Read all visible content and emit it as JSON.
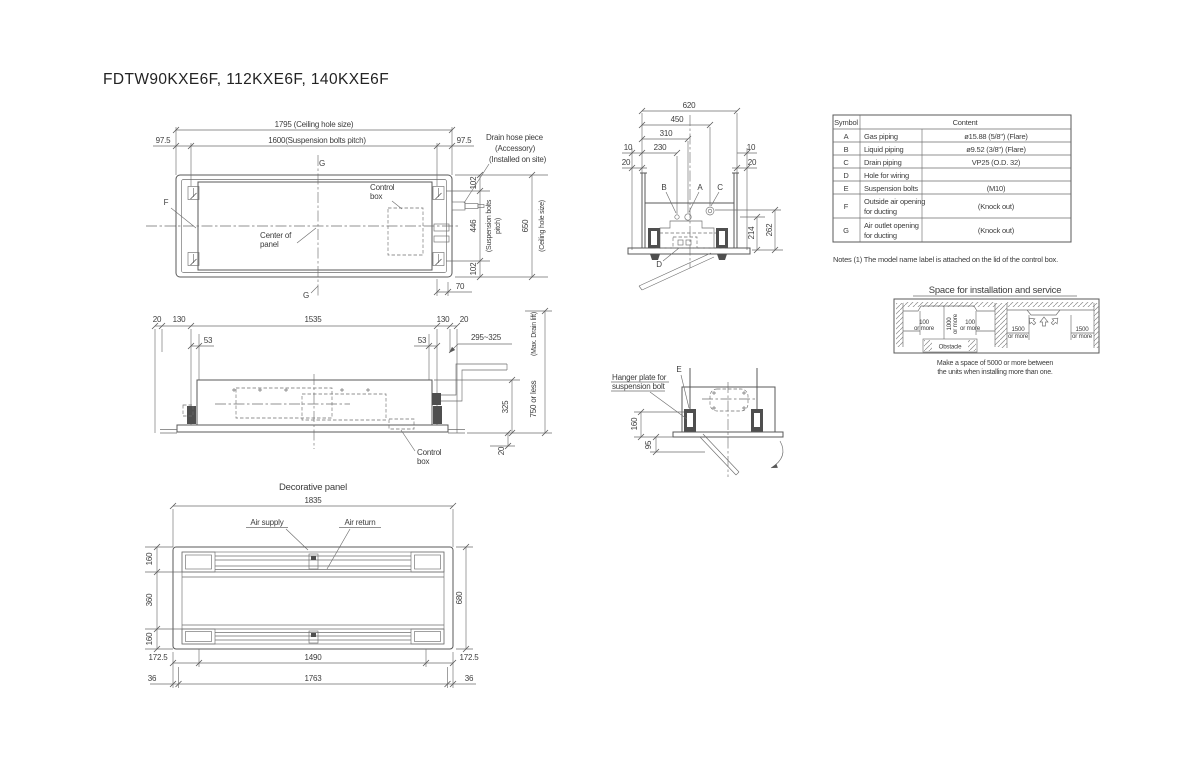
{
  "title": "FDTW90KXE6F, 112KXE6F, 140KXE6F",
  "plan_view": {
    "dim_ceiling_width": "1795 (Ceiling hole size)",
    "dim_bolt_pitch_width": "1600(Suspension bolts pitch)",
    "offset_left": "97.5",
    "offset_right": "97.5",
    "section_g_top": "G",
    "section_g_bottom": "G",
    "symbol_f": "F",
    "control_box_l1": "Control",
    "control_box_l2": "box",
    "center_l1": "Center of",
    "center_l2": "panel",
    "drain_l1": "Drain hose piece",
    "drain_l2": "(Accessory)",
    "drain_l3": "(Installed on site)",
    "dim_102_top": "102",
    "dim_446": "446",
    "bolt_pitch_l1": "(Suspension bolts",
    "bolt_pitch_l2": "pitch)",
    "dim_650": "650",
    "ceiling_note": "(Ceiling hole size)",
    "dim_102_bottom": "102",
    "dim_70": "70"
  },
  "side_view": {
    "dim_20_l": "20",
    "dim_130_l": "130",
    "dim_1535": "1535",
    "dim_130_r": "130",
    "dim_20_r": "20",
    "dim_53_l": "53",
    "dim_53_r": "53",
    "dim_drain_range": "295~325",
    "max_drain_lift": "(Max. Drain lift)",
    "dim_750": "750 or less",
    "dim_325": "325",
    "dim_20_b": "20",
    "control_box_l1": "Control",
    "control_box_l2": "box"
  },
  "end_view": {
    "dim_620": "620",
    "dim_450": "450",
    "dim_310": "310",
    "dim_230": "230",
    "dim_10_l": "10",
    "dim_20_l": "20",
    "dim_10_r": "10",
    "dim_20_r": "20",
    "sym_b": "B",
    "sym_a": "A",
    "sym_c": "C",
    "sym_d": "D",
    "dim_214": "214",
    "dim_262": "262"
  },
  "hanger_view": {
    "label_l1": "Hanger plate for",
    "label_l2": "suspension bolt",
    "sym_e": "E",
    "dim_160": "160",
    "dim_95": "95"
  },
  "panel_view": {
    "title": "Decorative panel",
    "dim_1835": "1835",
    "air_supply": "Air supply",
    "air_return": "Air return",
    "dim_160_t": "160",
    "dim_360": "360",
    "dim_160_b": "160",
    "dim_680": "680",
    "dim_1725_l": "172.5",
    "dim_1490": "1490",
    "dim_1725_r": "172.5",
    "dim_36_l": "36",
    "dim_1763": "1763",
    "dim_36_r": "36"
  },
  "symbol_table": {
    "col_symbol": "Symbol",
    "col_content": "Content",
    "rows": [
      {
        "symbol": "A",
        "name": "Gas piping",
        "name2": "",
        "value": "ø15.88 (5/8\") (Flare)"
      },
      {
        "symbol": "B",
        "name": "Liquid piping",
        "name2": "",
        "value": "ø9.52 (3/8\") (Flare)"
      },
      {
        "symbol": "C",
        "name": "Drain piping",
        "name2": "",
        "value": "VP25 (O.D. 32)"
      },
      {
        "symbol": "D",
        "name": "Hole for wiring",
        "name2": "",
        "value": ""
      },
      {
        "symbol": "E",
        "name": "Suspension bolts",
        "name2": "",
        "value": "(M10)"
      },
      {
        "symbol": "F",
        "name": "Outside air opening",
        "name2": "for ducting",
        "value": "(Knock out)"
      },
      {
        "symbol": "G",
        "name": "Air outlet opening",
        "name2": "for ducting",
        "value": "(Knock out)"
      }
    ]
  },
  "notes": "Notes (1) The model name label is attached on the lid of the control box.",
  "installation": {
    "title": "Space for installation and service",
    "left_100_1": "100",
    "left_100_1b": "or more",
    "left_1000": "1000",
    "left_1000b": "or more",
    "left_100_2": "100",
    "left_100_2b": "or more",
    "obstacle": "Obstacle",
    "right_1500_1": "1500",
    "right_1500_1b": "or more",
    "right_1500_2": "1500",
    "right_1500_2b": "or more",
    "caption_l1": "Make a space of 5000 or more between",
    "caption_l2": "the units when installing more than one."
  }
}
